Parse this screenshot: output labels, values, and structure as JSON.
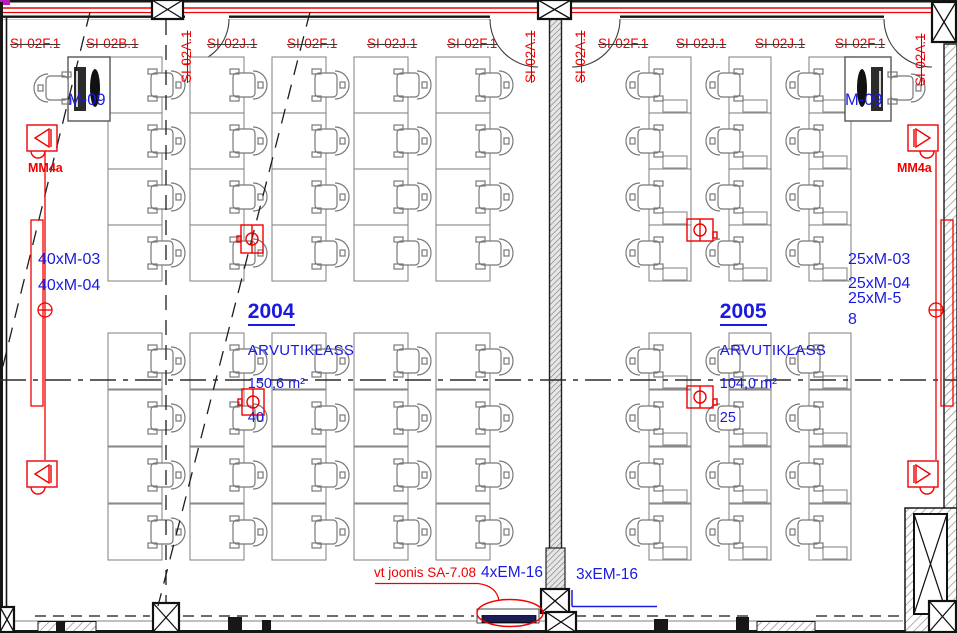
{
  "drawing": {
    "top_labels": [
      {
        "text": "SI-02F.1",
        "x": 10
      },
      {
        "text": "SI-02B.1",
        "x": 86
      },
      {
        "text": "SI-02J.1",
        "x": 207
      },
      {
        "text": "SI-02F.1",
        "x": 287
      },
      {
        "text": "SI-02J.1",
        "x": 367
      },
      {
        "text": "SI-02F.1",
        "x": 447
      },
      {
        "text": "SI-02F.1",
        "x": 598
      },
      {
        "text": "SI-02J.1",
        "x": 676
      },
      {
        "text": "SI-02J.1",
        "x": 755
      },
      {
        "text": "SI-02F.1",
        "x": 835
      }
    ],
    "vertical_labels": [
      {
        "text": "SI-02A.1",
        "x": 180,
        "y": 83
      },
      {
        "text": "SI-02A.1",
        "x": 524,
        "y": 83
      },
      {
        "text": "SI-02A.1",
        "x": 574,
        "y": 83
      },
      {
        "text": "SI-02A.1",
        "x": 914,
        "y": 86
      }
    ],
    "rooms": [
      {
        "number": "2004",
        "name": "ARVUTIKLASS",
        "area": "150,6 m²",
        "seats": "40",
        "label_x": 230,
        "label_y": 284
      },
      {
        "number": "2005",
        "name": "ARVUTIKLASS",
        "area": "104,0 m²",
        "seats": "25",
        "label_x": 702,
        "label_y": 284
      }
    ],
    "equipment_left": [
      "40xM-03",
      "40xM-04"
    ],
    "equipment_right": [
      "25xM-03",
      "25xM-04",
      "25xM-5",
      "8"
    ],
    "teacher_label_left": "M-09",
    "teacher_label_right": "M-09",
    "mm4a_left": "MM4a",
    "mm4a_right": "MM4a",
    "note_red": "vt joonis SA-7.08",
    "em16_left": "4xEM-16",
    "em16_right": "3xEM-16",
    "colors": {
      "red": "#f00000",
      "blue": "#1a1ae0",
      "wall": "#171717",
      "desk": "#8a8a8a"
    }
  },
  "plan": {
    "grids": [
      {
        "room": "2004",
        "cols": [
          108,
          190,
          272,
          354,
          436
        ],
        "row_groups": [
          [
            57,
            113,
            169,
            225
          ],
          [
            333,
            390,
            447,
            504
          ]
        ],
        "desk_w": 54,
        "desk_h": 56,
        "chair": "right",
        "tray": false
      },
      {
        "room": "2005",
        "cols": [
          649,
          729,
          809
        ],
        "row_groups": [
          [
            57,
            113,
            169,
            225
          ],
          [
            333,
            390,
            447,
            504
          ]
        ],
        "desk_w": 42,
        "desk_h": 56,
        "chair": "left",
        "tray": true
      }
    ],
    "teacher_stations": [
      {
        "x": 68,
        "y": 57,
        "w": 42,
        "h": 64,
        "chair": "left"
      },
      {
        "x": 845,
        "y": 57,
        "w": 46,
        "h": 64,
        "chair": "right"
      }
    ],
    "floor_boxes": [
      {
        "x": 241,
        "y": 225,
        "w": 22,
        "h": 28,
        "o": "v"
      },
      {
        "x": 242,
        "y": 389,
        "w": 22,
        "h": 26,
        "o": "v"
      },
      {
        "x": 687,
        "y": 219,
        "w": 26,
        "h": 22,
        "o": "h"
      },
      {
        "x": 687,
        "y": 386,
        "w": 26,
        "h": 22,
        "o": "h"
      }
    ],
    "speakers": [
      {
        "x": 27,
        "y": 125,
        "dir": 1
      },
      {
        "x": 27,
        "y": 461,
        "dir": 1
      },
      {
        "x": 908,
        "y": 125,
        "dir": -1
      },
      {
        "x": 908,
        "y": 461,
        "dir": -1
      }
    ]
  }
}
